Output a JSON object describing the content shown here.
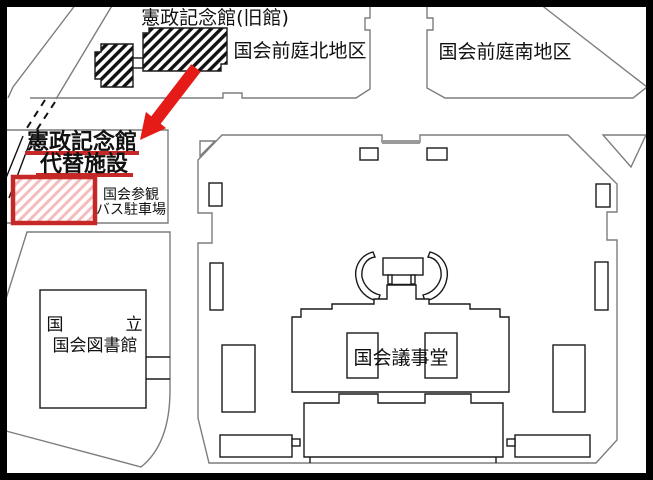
{
  "map": {
    "labels": {
      "old_hall": "憲政記念館(旧館)",
      "north_garden": "国会前庭北地区",
      "south_garden": "国会前庭南地区",
      "annex_line1": "憲政記念館",
      "annex_line2": "代替施設",
      "bus_line1": "国会参観",
      "bus_line2": "バス駐車場",
      "library_line1_left": "国",
      "library_line1_right": "立",
      "library_line2": "国会図書館",
      "diet_building": "国会議事堂"
    },
    "colors": {
      "highlight_red": "#e41b17",
      "underline_red": "#c62828",
      "hatch_pink": "#f3bdbd",
      "outline_black": "#1a1a1a",
      "road_gray": "#7d7d7d"
    }
  }
}
